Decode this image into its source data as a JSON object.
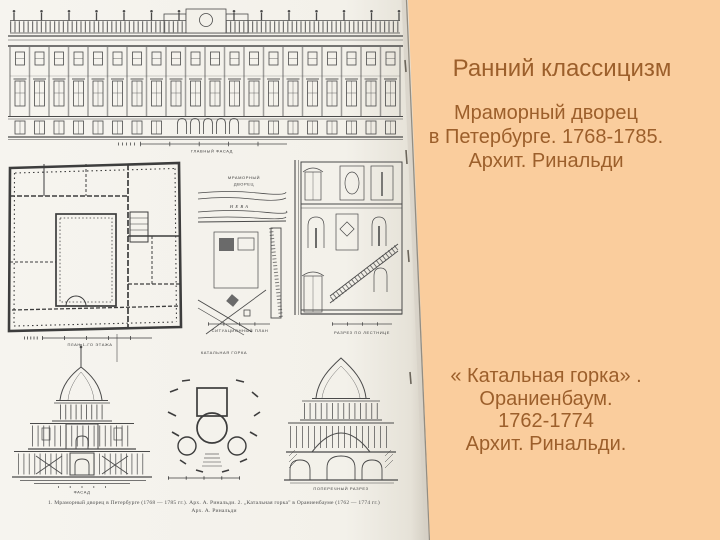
{
  "slide": {
    "background_color": "#FACD9D",
    "text_color": "#9C5F2B"
  },
  "right_panel": {
    "title": "Ранний классицизм",
    "marble_palace": [
      "Мраморный дворец",
      "в Петербурге. 1768-1785.",
      "Архит. Ринальди"
    ],
    "katalnaya": [
      "« Катальная горка» .",
      "Ораниенбаум.",
      "1762-1774",
      "Архит. Ринальди."
    ]
  },
  "scan": {
    "facade_scale_label": "ГЛАВНЫЙ ФАСАД",
    "plan_scale_label": "ПЛАН 1-ГО ЭТАЖА",
    "site_plan_title1": "МРАМОРНЫЙ",
    "site_plan_title2": "ДВОРЕЦ",
    "river_label": "НЕВА",
    "site_scale_label": "СИТУАЦИОННЫЙ ПЛАН",
    "stair_caption": "РАЗРЕЗ ПО ЛЕСТНИЦЕ",
    "gorka_plan_title": "КАТАЛЬНАЯ ГОРКА",
    "gorka_facade_label": "ФАСАД",
    "gorka_section_label": "ПОПЕРЕЧНЫЙ РАЗРЕЗ",
    "caption_line1": "1. Мраморный дворец в Петербурге (1768 — 1785 гг.). Арх. А. Ринальди. 2. „Катальная горка\" в Ораниенбауме (1762 — 1774 гг.)",
    "caption_line2": "Арх. А. Ринальди"
  }
}
